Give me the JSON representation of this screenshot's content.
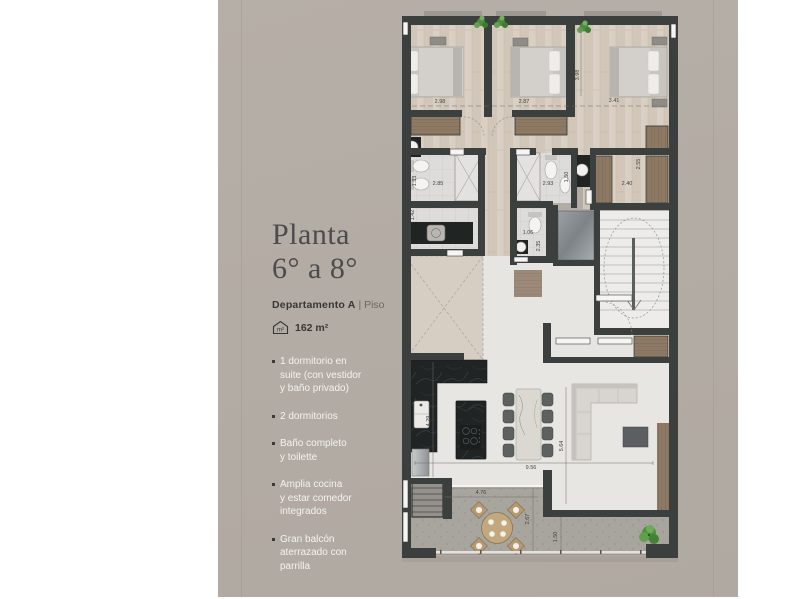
{
  "page": {
    "background": "#ffffff",
    "panel_color": "#b3aca4"
  },
  "sidebar": {
    "title": "Planta\n6° a 8°",
    "unit_name": "Departamento A",
    "unit_divider": "|",
    "unit_type": "Piso",
    "area_value": "162 m²",
    "area_icon": "house-m2-icon",
    "features": [
      "1 dormitorio en\nsuite (con vestidor\ny baño privado)",
      "2 dormitorios",
      "Baño completo\ny toilette",
      "Amplia cocina\ny estar comedor\nintegrados",
      "Gran balcón\naterrazado con\nparrilla"
    ]
  },
  "floorplan": {
    "dimensions": {
      "bedroom1_width": "2.98",
      "bedroom2_width": "2.87",
      "bedroom3_width": "3.41",
      "bedroom3_depth": "3.98",
      "bath1_depth": "1.33",
      "bath1_width": "2.85",
      "bath2_width": "2.93",
      "bath2_depth": "1.50",
      "vestidor_width": "2.40",
      "vestidor_depth": "2.55",
      "laundry_depth": "1.42",
      "toilette_width": "1.06",
      "toilette_depth": "2.35",
      "kitchen_depth": "4.29",
      "living_width": "9.56",
      "living_depth": "5.64",
      "terrace_width": "4.76",
      "terrace_depth": "2.67",
      "terrace_right_depth": "1.50"
    },
    "colors": {
      "wall": "#3b403f",
      "wood_floor": "#d9cfc2",
      "wardrobe_wood": "#8e7a64",
      "terrace_floor": "#a8a49e",
      "counter_black": "#202424",
      "plant_green": "#5f9e4c"
    }
  }
}
